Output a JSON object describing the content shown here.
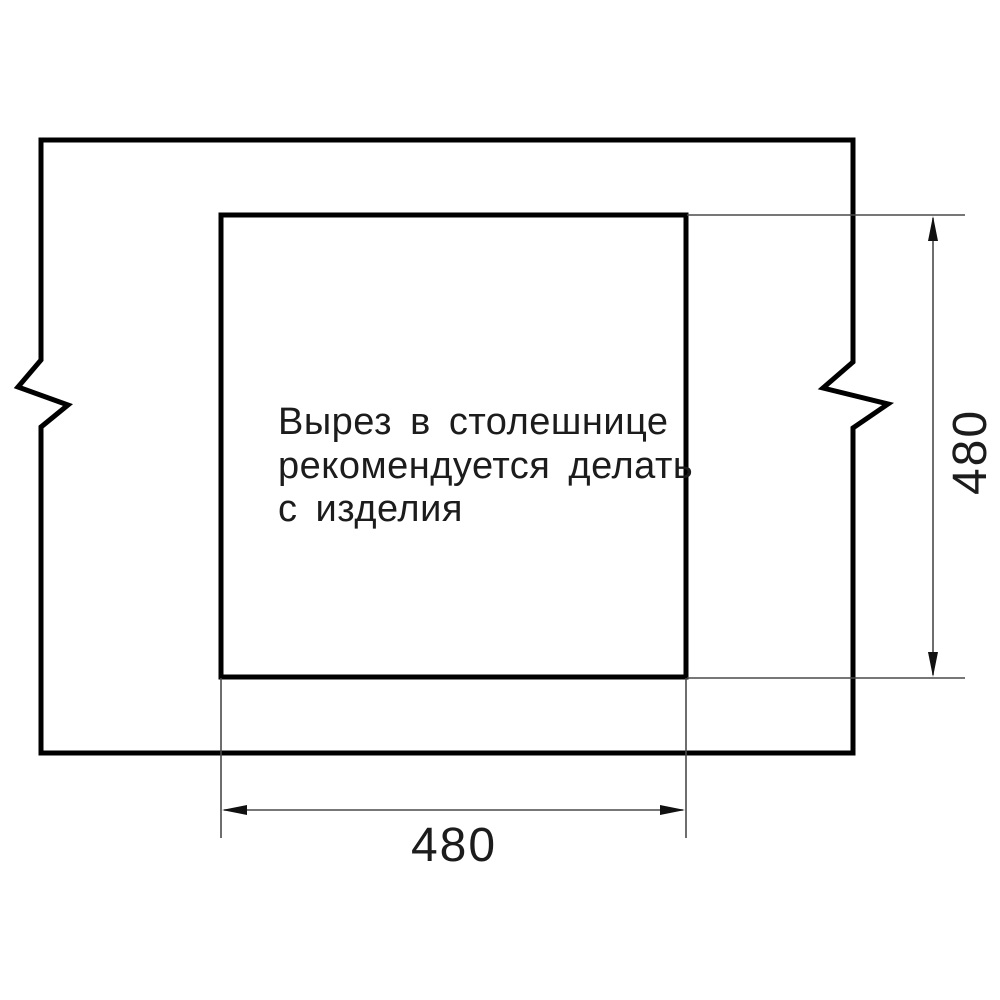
{
  "drawing": {
    "note": {
      "lines": [
        "Вырез в столешнице",
        "рекомендуется делать",
        "с изделия"
      ]
    },
    "dimensions": {
      "cutout_width": "480",
      "cutout_height": "480"
    },
    "colors": {
      "outline": "#000000",
      "thin_line": "#4a4a4a",
      "text": "#1c1c1c",
      "background": "#ffffff"
    }
  }
}
